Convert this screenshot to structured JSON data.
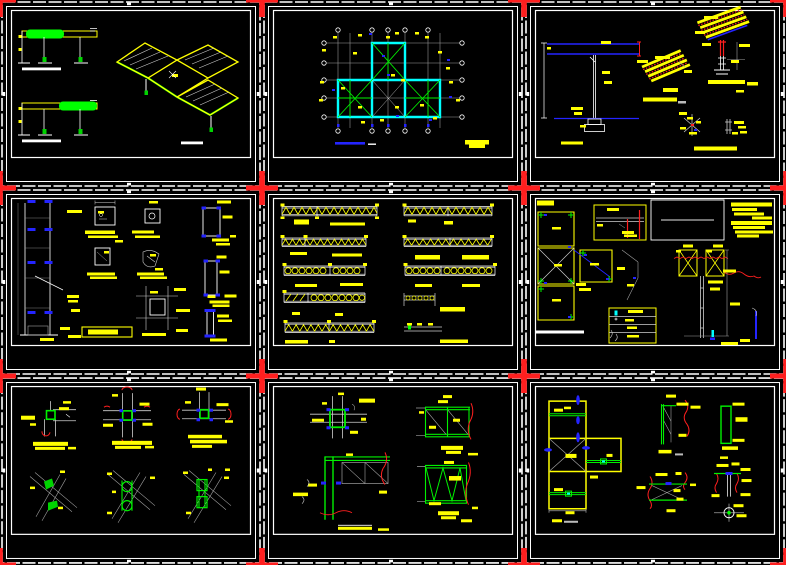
{
  "document": {
    "kind": "cad-multi-sheet-drawing-preview",
    "sheet_count": 9,
    "grid_layout": "3x3",
    "background": "#000000"
  },
  "palette": {
    "sheet_frame": "#ffffff",
    "registration_mark_red": "#ff1f1f",
    "dimension_text_yellow": "#ffff00",
    "member_green": "#00f000",
    "wall_cyan": "#00ffff",
    "accent_blue": "#2424ff",
    "grid_gray": "#9f9f9f"
  },
  "sheets": [
    {
      "id": "sheet-1",
      "row": 1,
      "col": 1,
      "name": "beam elevations and isometric deck view"
    },
    {
      "id": "sheet-2",
      "row": 1,
      "col": 2,
      "name": "framing plan with cyan walls and grid bubbles"
    },
    {
      "id": "sheet-3",
      "row": 1,
      "col": 3,
      "name": "T column section and hatched roof panel details"
    },
    {
      "id": "sheet-4",
      "row": 2,
      "col": 1,
      "name": "column elevation and plate details"
    },
    {
      "id": "sheet-5",
      "row": 2,
      "col": 2,
      "name": "truss elevations"
    },
    {
      "id": "sheet-6",
      "row": 2,
      "col": 3,
      "name": "bracing plan, schedule table and column assembly"
    },
    {
      "id": "sheet-7",
      "row": 3,
      "col": 1,
      "name": "joint details in plan and isometric"
    },
    {
      "id": "sheet-8",
      "row": 3,
      "col": 2,
      "name": "column-beam connection and truss frame details"
    },
    {
      "id": "sheet-9",
      "row": 3,
      "col": 3,
      "name": "plan outline and splice details"
    }
  ],
  "markers": {
    "type": "red-cross",
    "count": 16,
    "positions_x": [
      0,
      262,
      524,
      786
    ],
    "positions_y": [
      0,
      188,
      376,
      565
    ]
  }
}
